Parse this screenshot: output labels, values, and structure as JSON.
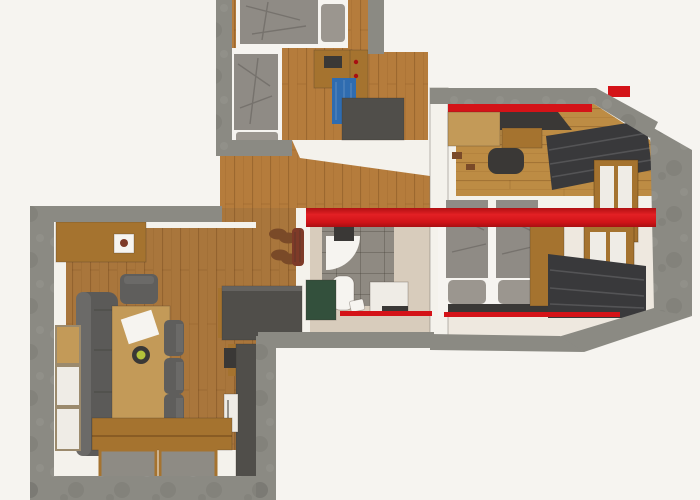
{
  "image": {
    "kind": "3d-floor-plan-top-view",
    "description": "Photorealistic top-down 3D render of an apartment floor plan on a white background; no text labels are rendered in the image",
    "canvas": {
      "width": 700,
      "height": 500
    }
  },
  "colors": {
    "outside": "#ffffff",
    "wall": "#8b8a83",
    "wallDark": "#76756f",
    "wallLight": "#a3a29b",
    "innerWall": "#f4f2ec",
    "woodWarm": "#b57c3c",
    "woodGolden": "#bd8c44",
    "woodLiving": "#a9763c",
    "woodLight": "#c39a58",
    "woodFurn": "#a5732f",
    "woodDark": "#7c5020",
    "floorCream": "#eee8df",
    "floorBeige": "#d8ccbc",
    "red": "#d41318",
    "redDark": "#a80f12",
    "duvet": "#8f8b85",
    "pillow": "#9b968f",
    "curtain": "#39393b",
    "counterDark": "#504e4a",
    "sofaGray": "#5b5a58",
    "sofaBack": "#6b6a68",
    "chairGray": "#5f5e5c",
    "green": "#33503c",
    "blue": "#2f6cb0",
    "white": "#f6f4f0",
    "tileGray": "#8f8a82",
    "shoeBrown": "#7a4a28",
    "jacketBrown": "#7e3a28",
    "applianceWhite": "#efece6",
    "matGray": "#8e8b84",
    "darkItem": "#3a3836",
    "bowlGreen": "#b4c23a",
    "frameRed": "#b04038"
  },
  "rooms": [
    {
      "id": "bedroom-upper-left",
      "contents": [
        "single-bed-horizontal",
        "single-bed-vertical",
        "desk",
        "wardrobe-panel",
        "blue-towels",
        "dark-cabinet"
      ]
    },
    {
      "id": "bedroom-upper-right",
      "contents": [
        "red-wall-stripe",
        "dark-desk",
        "desk-chair",
        "light-wood-cabinet",
        "dark-curtains",
        "wood-window"
      ]
    },
    {
      "id": "master-bedroom",
      "contents": [
        "double-bed",
        "two-duvets",
        "two-pillows",
        "dark-rug",
        "red-floor-trim",
        "wood-wall-panel",
        "wood-window",
        "dark-curtains"
      ]
    },
    {
      "id": "bathroom",
      "contents": [
        "gray-tiled-shower",
        "shower-tray",
        "shower-fixture",
        "toilet",
        "washbasin-cabinet",
        "green-cabinet",
        "red-floor-trim"
      ]
    },
    {
      "id": "hallway-entry",
      "contents": [
        "wood-floor",
        "shoes",
        "hanging-jackets"
      ]
    },
    {
      "id": "living-kitchen",
      "contents": [
        "sideboard-with-picture",
        "corner-sofa",
        "dining-table",
        "paper-sheet",
        "fruit-bowl",
        "four-chairs",
        "kitchen-counter",
        "tall-kitchen-unit",
        "appliance",
        "left-windows",
        "wood-bench",
        "floor-mats"
      ]
    }
  ],
  "overlay": {
    "red_banner": {
      "present": true,
      "orientation": "horizontal",
      "text": ""
    }
  }
}
